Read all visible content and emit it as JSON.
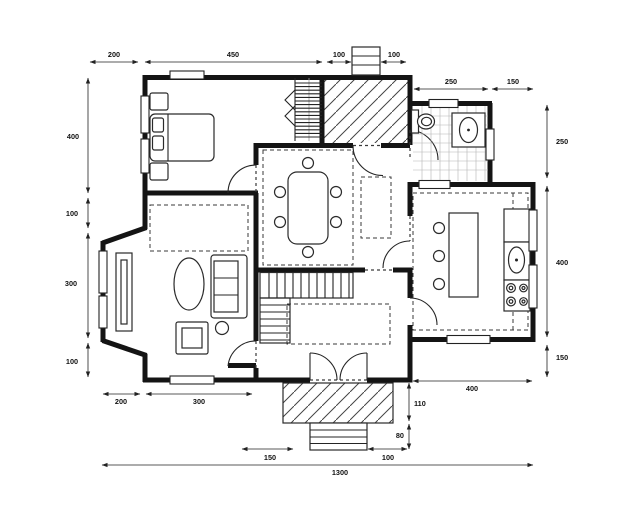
{
  "figure": {
    "type": "architectural floor plan",
    "units_total_width": "1300"
  },
  "dimensions": {
    "top": [
      "200",
      "450",
      "100",
      "100"
    ],
    "bath_top": [
      "250",
      "150"
    ],
    "left": [
      "400",
      "100",
      "300",
      "100"
    ],
    "right": [
      "250",
      "400",
      "150"
    ],
    "bottom_inner": [
      "200",
      "300"
    ],
    "bottom_outer": [
      "150",
      "100"
    ],
    "total": [
      "1300"
    ],
    "kitchen_bottom": [
      "400"
    ],
    "porch_side": [
      "110",
      "80"
    ]
  }
}
